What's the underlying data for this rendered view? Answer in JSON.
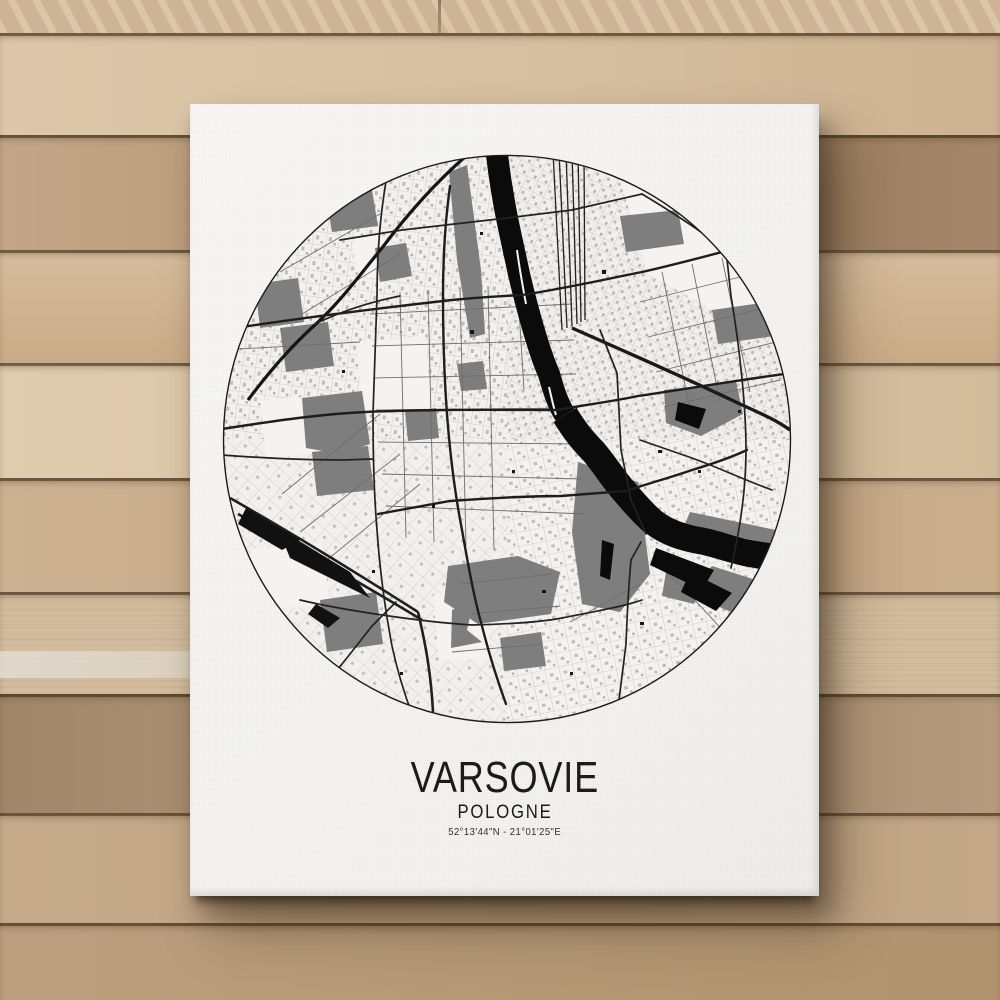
{
  "artwork": {
    "city_name": "VARSOVIE",
    "country_name": "POLOGNE",
    "coordinates": "52°13'44\"N - 21°01'25\"E"
  },
  "map_data": {
    "type": "city-street-map",
    "city_depicted": "Warsaw (Varsovie), Poland",
    "crop": "circle",
    "viewbox": "0 0 574 574",
    "colors": {
      "background": "#f5f4f2",
      "water": "#0b0b0b",
      "parks": "#7e7e7e",
      "major_roads": "#1d1d1d",
      "minor_roads": "#6e6e6e",
      "outline": "#1c1c1c"
    },
    "layers": [
      {
        "name": "open-areas",
        "attrs": {
          "fill": "#f4f3f1",
          "stroke": "none"
        },
        "paths": [
          "M137,190 L205,184 L212,256 L142,263 Z",
          "M135,88 C150,80 170,82 176,96 C180,112 168,128 150,126 C136,124 130,100 135,88 Z",
          "M400,28 L500,60 L560,140 L536,182 L428,122 Z",
          "M213,443 L266,438 L271,506 L219,509 Z",
          "M30,398 L102,390 L110,452 L36,458 Z",
          "M40,248 L112,243 L117,300 L46,306 Z"
        ]
      },
      {
        "name": "parks",
        "attrs": {
          "fill": "#7e7e7e",
          "stroke": "none"
        },
        "paths": [
          "M444,238 L516,230 L523,262 L481,284 L446,271 Z",
          "M229,20 L247,13 L261,118 L265,182 L250,186 L237,108 Z",
          "M35,132 L78,126 L84,170 L40,176 Z",
          "M60,176 L108,170 L114,214 L66,220 Z",
          "M82,246 L142,239 L150,292 L120,302 L86,296 Z",
          "M92,300 L148,294 L154,338 L97,344 Z",
          "M106,44 L152,38 L158,74 L112,80 Z",
          "M155,96 L186,91 L192,124 L160,130 Z",
          "M237,212 L263,209 L267,237 L241,239 Z",
          "M228,414 L298,404 L340,420 L331,462 L258,472 L224,450 Z",
          "M358,310 L418,330 L430,422 L400,460 L362,452 L352,380 Z",
          "M492,414 L542,430 L520,464 L468,441 Z",
          "M446,420 L482,428 L474,452 L442,444 Z",
          "M400,64 L458,58 L464,92 L406,100 Z",
          "M492,158 L548,150 L554,184 L498,192 Z",
          "M470,360 L556,378 L551,392 L464,374 Z",
          "M100,448 L156,440 L163,492 L107,500 Z",
          "M185,260 L216,256 L219,286 L188,289 Z",
          "M280,486 L321,480 L326,514 L284,519 Z",
          "M232,458 L254,448 L247,478 L262,490 L231,496 Z"
        ]
      },
      {
        "name": "minor-roads",
        "attrs": {
          "fill": "none",
          "stroke": "#6e6e6e",
          "stroke-width": "0.9"
        },
        "paths": [
          "M150,162 L352,152",
          "M152,194 L354,188",
          "M154,226 L356,222",
          "M156,258 L358,256",
          "M158,290 L360,292",
          "M162,322 L362,327",
          "M166,354 L366,362",
          "M180,140 L186,386",
          "M208,138 L214,390",
          "M240,136 L246,394",
          "M268,134 L274,398",
          "M298,142 L304,238",
          "M420,150 L540,120",
          "M428,185 L548,155",
          "M436,220 L556,190",
          "M444,255 L560,228",
          "M442,120 L470,258",
          "M472,112 L500,250",
          "M502,106 L530,240",
          "M80,380 L180,302",
          "M102,412 L200,332",
          "M62,342 L160,262",
          "M240,432 L332,422",
          "M250,462 L340,454",
          "M232,500 L322,492",
          "M350,470 L420,432",
          "M432,408 C460,432 486,458 512,490",
          "M60,120 L160,62",
          "M82,162 L180,102",
          "M2,198 L140,190"
        ]
      },
      {
        "name": "railway-northwest",
        "attrs": {
          "fill": "none",
          "stroke": "#151515",
          "stroke-width": "3.2"
        },
        "paths": [
          "M28,248 C55,212 78,188 96,172 C122,148 142,120 162,96 C186,64 214,32 246,4"
        ]
      },
      {
        "name": "railway-yard-east",
        "attrs": {
          "fill": "none",
          "stroke": "#222222",
          "stroke-width": "1.3"
        },
        "paths": [
          "M333,0 L342,178",
          "M339,0 L347,176",
          "M346,0 L352,174",
          "M352,0 L357,172",
          "M358,0 L361,170",
          "M364,0 L365,168"
        ]
      },
      {
        "name": "railway-trunk-southeast",
        "attrs": {
          "fill": "none",
          "stroke": "#1a1a1a",
          "stroke-width": "3.4"
        },
        "paths": [
          "M352,176 C402,198 470,228 520,252 C542,262 556,268 570,278"
        ]
      },
      {
        "name": "railway-southwest",
        "attrs": {
          "fill": "none",
          "stroke": "#1f1f1f",
          "stroke-width": "2.6"
        },
        "paths": [
          "M10,346 C70,380 132,418 198,460",
          "M18,362 C78,396 140,430 202,468",
          "M198,460 C206,494 211,522 213,560"
        ]
      },
      {
        "name": "river-upper",
        "attrs": {
          "fill": "none",
          "stroke": "#0b0b0b",
          "stroke-width": "22",
          "stroke-linejoin": "round"
        },
        "paths": [
          "M276,-6 C282,50 291,84 299,122 C307,156 319,200 329,222 C334,240 338,252 345,263"
        ]
      },
      {
        "name": "river-lower",
        "attrs": {
          "fill": "none",
          "stroke": "#0b0b0b",
          "stroke-width": "27",
          "stroke-linejoin": "round"
        },
        "paths": [
          "M345,263 C355,279 362,288 373,299 C385,313 394,328 404,339 C414,351 422,360 432,369 C447,381 464,386 482,389 C497,392 512,398 527,401 C543,404 557,406 580,409"
        ]
      },
      {
        "name": "river-islands",
        "attrs": {
          "fill": "none",
          "stroke": "#f4f3f1",
          "stroke-width": "2"
        },
        "paths": [
          "M297,98 C300,120 303,136 306,152",
          "M329,235 C332,248 334,257 336,263"
        ]
      },
      {
        "name": "lakes-ponds",
        "attrs": {
          "fill": "#0b0b0b",
          "stroke": "none"
        },
        "paths": [
          "M436,396 L494,418 L482,438 L430,413 Z",
          "M458,250 L486,257 L479,277 L455,268 Z",
          "M470,420 L512,441 L496,459 L461,440 Z",
          "M382,388 L394,392 L390,428 L380,424 Z"
        ]
      },
      {
        "name": "railyard-masses",
        "attrs": {
          "fill": "#111111",
          "stroke": "none"
        },
        "paths": [
          "M58,376 L130,420 L150,446 L70,406 Z",
          "M26,356 L80,388 L62,398 L18,372 Z",
          "M96,452 L120,466 L108,476 L88,462 Z"
        ]
      },
      {
        "name": "major-roads",
        "attrs": {
          "fill": "none",
          "stroke": "#1d1d1d",
          "stroke-width": "2.4",
          "stroke-linecap": "round"
        },
        "paths": [
          "M2,277 C60,268 102,262 146,260 C212,257 282,258 336,258 C372,252 400,248 418,244 C472,236 532,226 572,221",
          "M230,34 C225,70 223,102 223,144 C223,182 224,222 227,262 C230,302 235,342 242,378 C248,412 254,446 262,474 C270,506 278,530 286,552",
          "M158,362 L230,349 C272,346 310,344 341,344 L406,339 C430,331 452,325 472,318 C492,312 512,305 527,298",
          "M2,178 C80,166 152,157 232,148 C262,145 282,144 302,143 C342,137 382,128 422,120 C462,111 502,100 532,92"
        ]
      },
      {
        "name": "secondary-roads",
        "attrs": {
          "fill": "none",
          "stroke": "#222222",
          "stroke-width": "1.7",
          "stroke-linecap": "round"
        },
        "paths": [
          "M120,88 L182,78 L287,66 L352,58 L422,42",
          "M168,18 C160,60 157,102 157,144 L153,262 C153,302 154,342 157,378 C160,422 166,462 172,494 C178,522 186,546 192,562",
          "M380,178 L397,221 L401,298 L411,348 L426,382",
          "M506,98 L511,144 C519,192 526,252 526,298 C526,340 519,382 511,416",
          "M421,390 L411,408 C408,440 407,466 406,492 L399,548",
          "M176,450 L152,474 L130,502 L106,532",
          "M80,448 C122,458 202,470 252,473 C292,472 322,470 342,466 C372,460 402,455 422,448",
          "M2,303 C42,306 82,308 122,308 L153,307",
          "M422,42 C452,60 482,80 506,98",
          "M420,288 L472,306 C502,317 522,327 552,338",
          "M95,172 C120,160 150,150 180,144"
        ]
      },
      {
        "name": "building-dots",
        "attrs": {
          "fill": "#161616",
          "stroke": "none"
        },
        "paths": [
          "M250,178 h4 v4 h-4 Z",
          "M292,318 h3 v3 h-3 Z",
          "M212,352 h3 v4 h-3 Z",
          "M438,298 h4 v3 h-4 Z",
          "M152,418 h3 v3 h-3 Z",
          "M322,438 h4 v3 h-4 Z",
          "M478,318 h3 v3 h-3 Z",
          "M382,118 h4 v4 h-4 Z",
          "M122,218 h3 v3 h-3 Z",
          "M518,258 h3 v3 h-3 Z",
          "M260,80 h3 v3 h-3 Z",
          "M420,470 h4 v3 h-4 Z",
          "M180,520 h3 v3 h-3 Z",
          "M350,520 h3 v3 h-3 Z"
        ]
      },
      {
        "name": "circle-outline",
        "clip": false,
        "attrs": {
          "fill": "none",
          "stroke": "#1c1c1c",
          "stroke-width": "1.4"
        },
        "paths": [
          "M3.5,287 a283.5,283.5 0 1 0 567,0 a283.5,283.5 0 1 0 -567,0"
        ]
      }
    ]
  }
}
